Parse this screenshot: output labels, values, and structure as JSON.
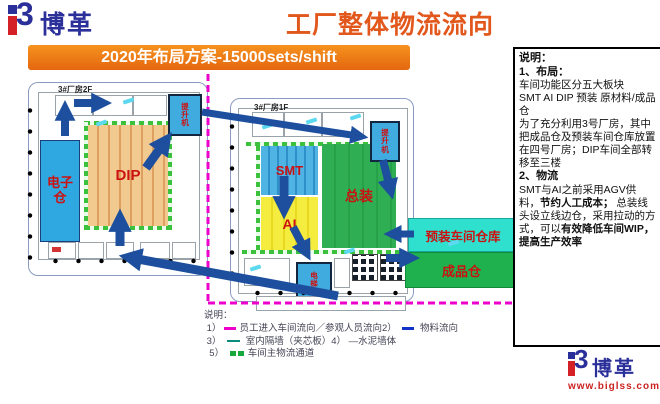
{
  "header": {
    "logo_text": "博革",
    "title": "工厂整体物流流向"
  },
  "banner": {
    "text": "2020年布局方案-15000sets/shift"
  },
  "diagram": {
    "building_left": {
      "name": "3#厂房2F",
      "electronics_warehouse": "电子仓",
      "dip": "DIP",
      "lift": "提升机"
    },
    "building_right": {
      "name": "3#厂房1F",
      "smt": "SMT",
      "ai": "AI",
      "assembly": "总装",
      "lift": "提升机",
      "elevator": "电梯"
    },
    "preassembly_warehouse": "预装车间仓库",
    "finished_goods_warehouse": "成品仓"
  },
  "legend": {
    "title": "说明：",
    "items": [
      {
        "num": "1）",
        "text": "员工进入车间流向／参观人员流向",
        "swatch": "magenta-dash"
      },
      {
        "num": "2）",
        "text": "物料流向",
        "swatch": "blue-dash"
      },
      {
        "num": "3）",
        "text": "室内隔墙（夹芯板）",
        "swatch": "teal-line"
      },
      {
        "num": "4）",
        "text": "—水泥墙体",
        "swatch": "black-line"
      },
      {
        "num": "5）",
        "text": "车间主物流通道",
        "swatch": "green-channel"
      }
    ]
  },
  "notes": {
    "title": "说明：",
    "s1_head": "1、布局：",
    "s1_l1": "车间功能区分五大板块",
    "s1_l2": "SMT AI DIP 预装 原材料/成品仓",
    "s1_l3": "为了充分利用3号厂房，其中把成品仓及预装车间仓库放置在四号厂房；DIP车间全部转移至三楼",
    "s2_head": "2、物流",
    "s2_t1": "SMT与AI之前采用AGV供料，",
    "s2_b1": "节约人工成本；",
    "s2_t2": "总装线头设立线边仓，采用拉动的方式，可以",
    "s2_b2": "有效降低车间WIP，提高生产效率"
  },
  "footer": {
    "logo_text": "博革",
    "url": "www.biglss.com"
  },
  "colors": {
    "title_orange": "#e2581c",
    "banner_orange": "#ef7d13",
    "logo_blue": "#2b2f9a",
    "logo_red": "#d42027",
    "arrow_blue": "#1d4f9e",
    "flow_magenta": "#ee00cc",
    "smt_blue": "#4fb3e4",
    "ai_yellow": "#f2ea3a",
    "assembly_green": "#2fae53",
    "dip_tan": "#f2c98f",
    "warehouse_cyan": "#2fe0cf"
  }
}
